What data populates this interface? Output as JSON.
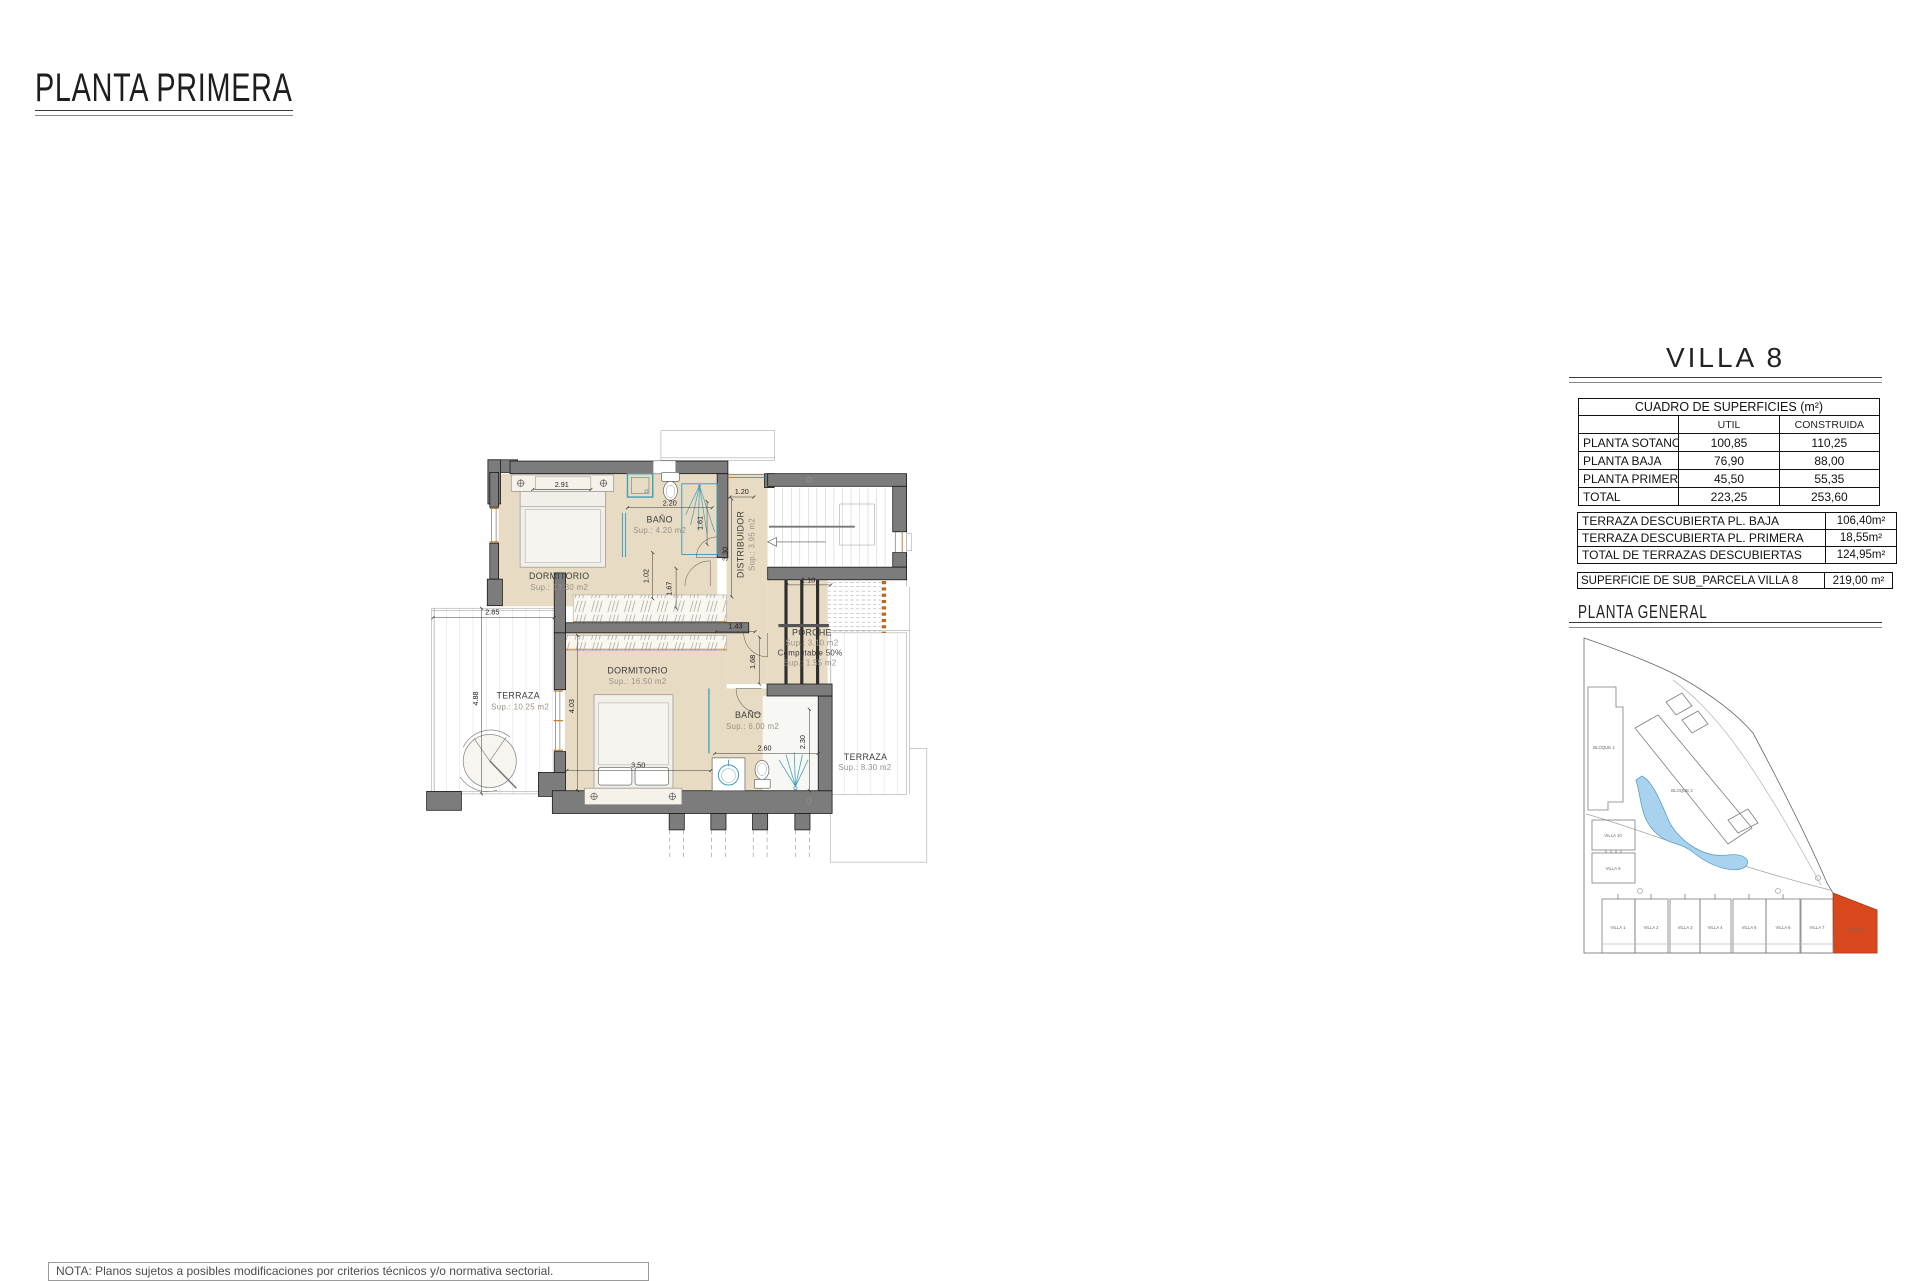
{
  "title": "PLANTA PRIMERA",
  "note": "NOTA: Planos sujetos a posibles modificaciones por criterios técnicos y/o normativa sectorial.",
  "villa": "VILLA 8",
  "tables": {
    "surfaces": {
      "title": "CUADRO DE SUPERFICIES (m²)",
      "col_util": "UTIL",
      "col_construida": "CONSTRUIDA",
      "rows": [
        {
          "label": "PLANTA SOTANO",
          "util": "100,85",
          "construida": "110,25"
        },
        {
          "label": "PLANTA BAJA",
          "util": "76,90",
          "construida": "88,00"
        },
        {
          "label": "PLANTA PRIMERA",
          "util": "45,50",
          "construida": "55,35"
        },
        {
          "label": "TOTAL",
          "util": "223,25",
          "construida": "253,60"
        }
      ]
    },
    "terraces": {
      "rows": [
        {
          "label": "TERRAZA DESCUBIERTA PL. BAJA",
          "value": "106,40m²"
        },
        {
          "label": "TERRAZA DESCUBIERTA PL. PRIMERA",
          "value": "18,55m²"
        },
        {
          "label": "TOTAL DE TERRAZAS DESCUBIERTAS",
          "value": "124,95m²"
        }
      ]
    },
    "parcel": {
      "label": "SUPERFICIE DE SUB_PARCELA VILLA 8",
      "value": "219,00 m²"
    }
  },
  "site": {
    "title": "PLANTA  GENERAL",
    "colors": {
      "highlight": "#d8481d",
      "pool": "#a9d2ee"
    },
    "labels": {
      "bloque1": "BLOQUE 1",
      "bloque2": "BLOQUE 2",
      "villa10": "VILLA 10",
      "villa9": "VILLA 9",
      "v1": "VILLA 1",
      "v2": "VILLA 2",
      "v3": "VILLA 3",
      "v4": "VILLA 4",
      "v5": "VILLA 5",
      "v6": "VILLA 6",
      "v7": "VILLA 7",
      "v8": "VILLA 8"
    }
  },
  "plan": {
    "rooms": {
      "dorm1": {
        "name": "DORMITORIO",
        "sup": "Sup.: 13.30  m2"
      },
      "bath1": {
        "name": "BAÑO",
        "sup": "Sup.: 4.20   m2"
      },
      "dist": {
        "name": "DISTRIBUIDOR",
        "sup": "Sup.: 3.95  m2"
      },
      "porch": {
        "name": "PORCHE",
        "sup": "Sup.: 3.10   m2",
        "computable": "Computable 50%",
        "computable_sup": "Sup.: 1.55   m2"
      },
      "dorm2": {
        "name": "DORMITORIO",
        "sup": "Sup.: 16.50  m2"
      },
      "bath2": {
        "name": "BAÑO",
        "sup": "Sup.: 6.00   m2"
      },
      "terrace1": {
        "name": "TERRAZA",
        "sup": "Sup.: 10.25  m2"
      },
      "terrace2": {
        "name": "TERRAZA",
        "sup": "Sup.: 8.30   m2"
      }
    },
    "dims": {
      "w291": "2.91",
      "w220": "2.20",
      "w120": "1.20",
      "h161": "1.61",
      "h330": "3.30",
      "h102": "1.02",
      "h167": "1.67",
      "w143": "1.43",
      "w118": "1.18",
      "w285": "2.85",
      "h488": "4.88",
      "h403": "4.03",
      "w350": "3.50",
      "h168": "1.68",
      "w260": "2.60",
      "h230": "2.30"
    }
  }
}
